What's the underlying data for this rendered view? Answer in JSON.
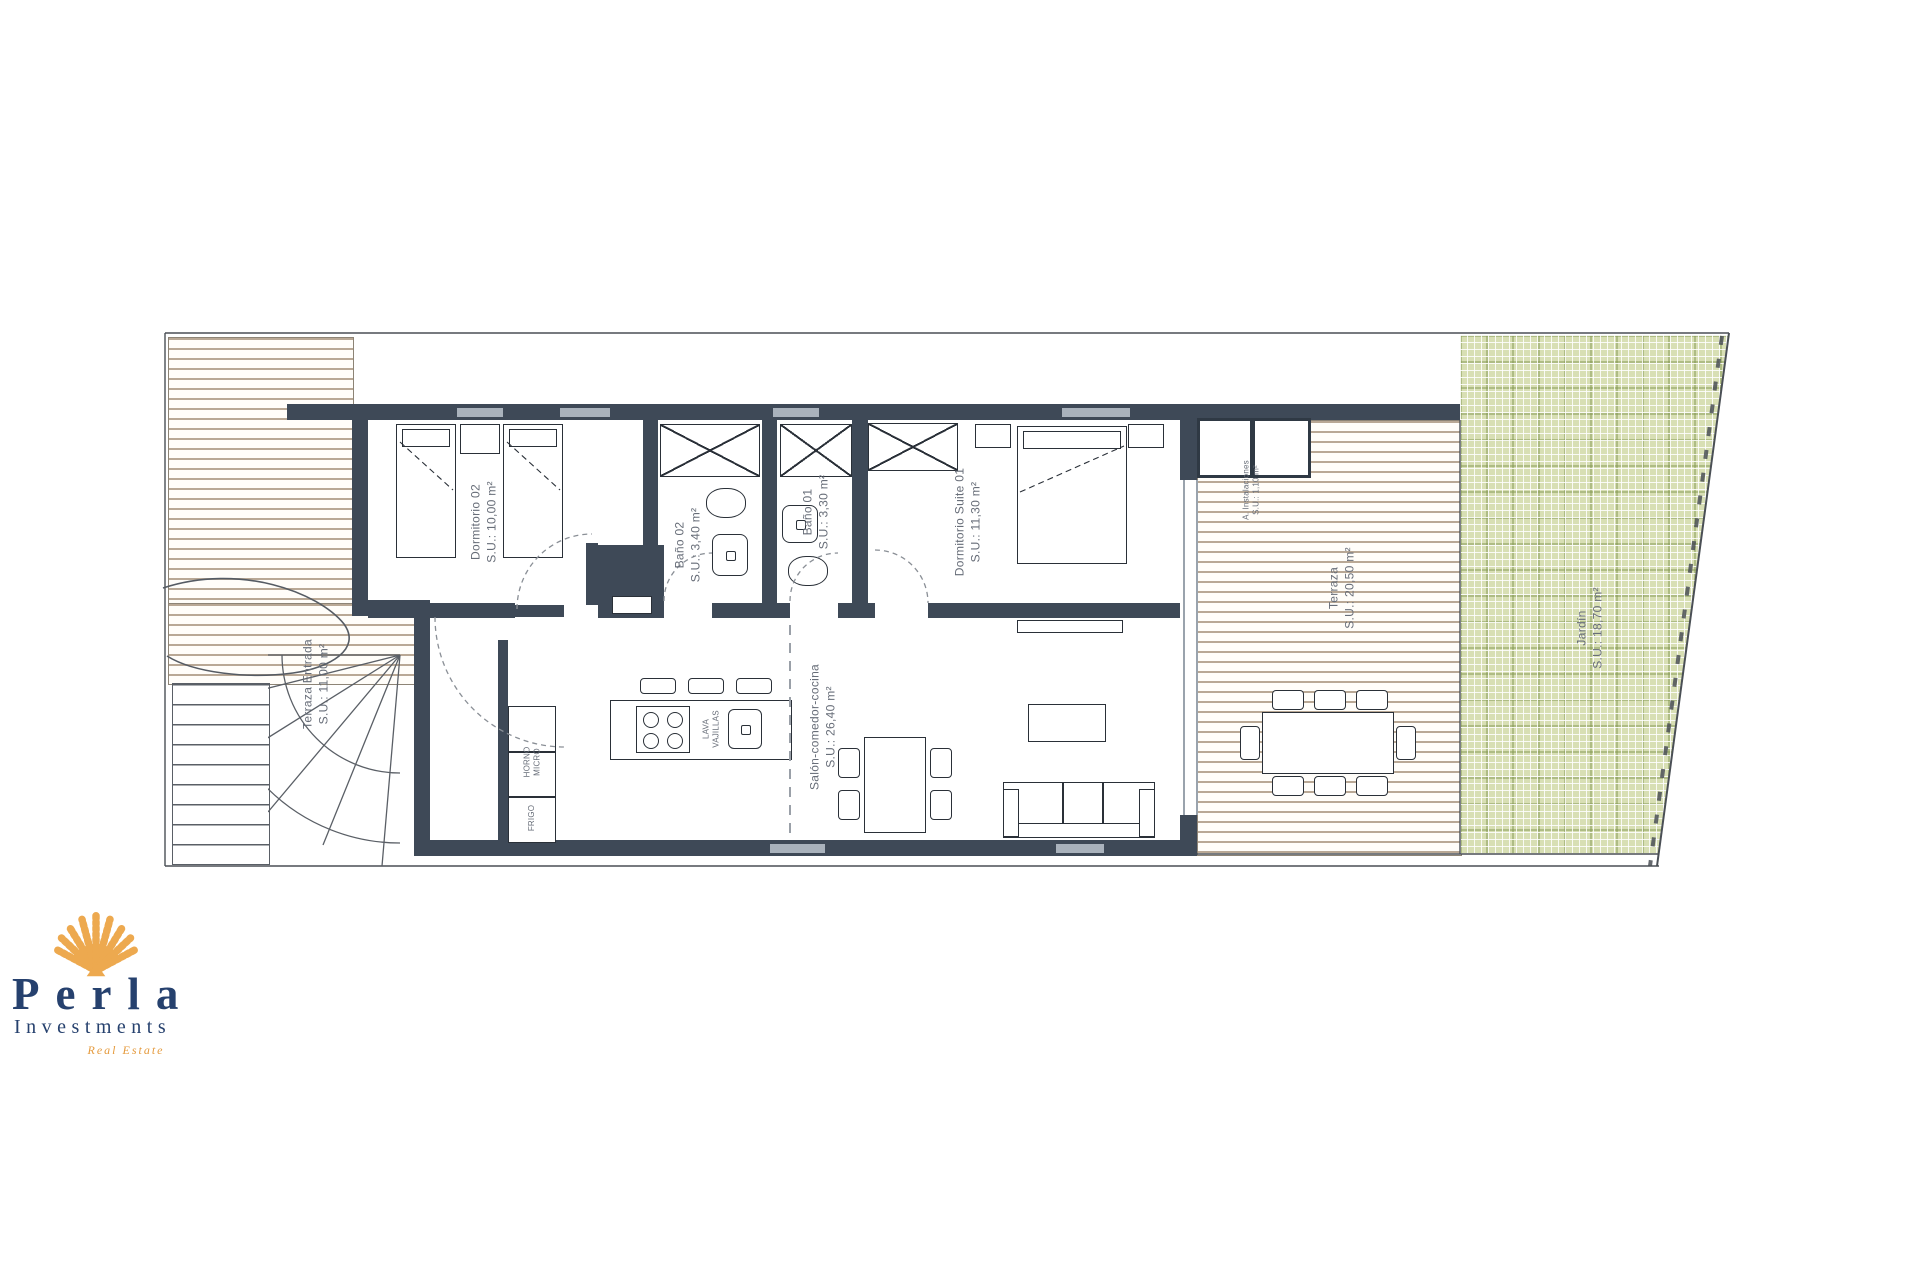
{
  "branding": {
    "name": "Perla",
    "subtitle": "Investments",
    "tagline": "Real Estate"
  },
  "rooms": [
    {
      "name": "Dormitorio 02",
      "area": "S.U.: 10,00 m²"
    },
    {
      "name": "Baño 02",
      "area": "S.U.: 3,40 m²"
    },
    {
      "name": "Baño 01",
      "area": "S.U.: 3,30 m²"
    },
    {
      "name": "Dormitorio Suite 01",
      "area": "S.U.: 11,30 m²"
    },
    {
      "name": "Salón-comedor-cocina",
      "area": "S.U.: 26,40 m²"
    },
    {
      "name": "Terraza Entrada",
      "area": "S.U.: 11,00 m²"
    },
    {
      "name": "Terraza",
      "area": "S.U.: 20,50 m²"
    },
    {
      "name": "Jardín",
      "area": "S.U.: 18,70 m²"
    },
    {
      "name": "A. Instalaciones",
      "area": "S.U.: 1,10 m²"
    }
  ],
  "kitchen": {
    "oven_line1": "HORNO",
    "oven_line2": "MICRO",
    "fridge": "FRIGO",
    "dishwasher_line1": "LAVA",
    "dishwasher_line2": "VAJILLAS"
  },
  "colors": {
    "wall": "#3e4957",
    "deck_stripe": "#b9a895",
    "garden": "#d8dfb4",
    "logo_navy": "#26416e",
    "logo_orange": "#e59a3c"
  }
}
